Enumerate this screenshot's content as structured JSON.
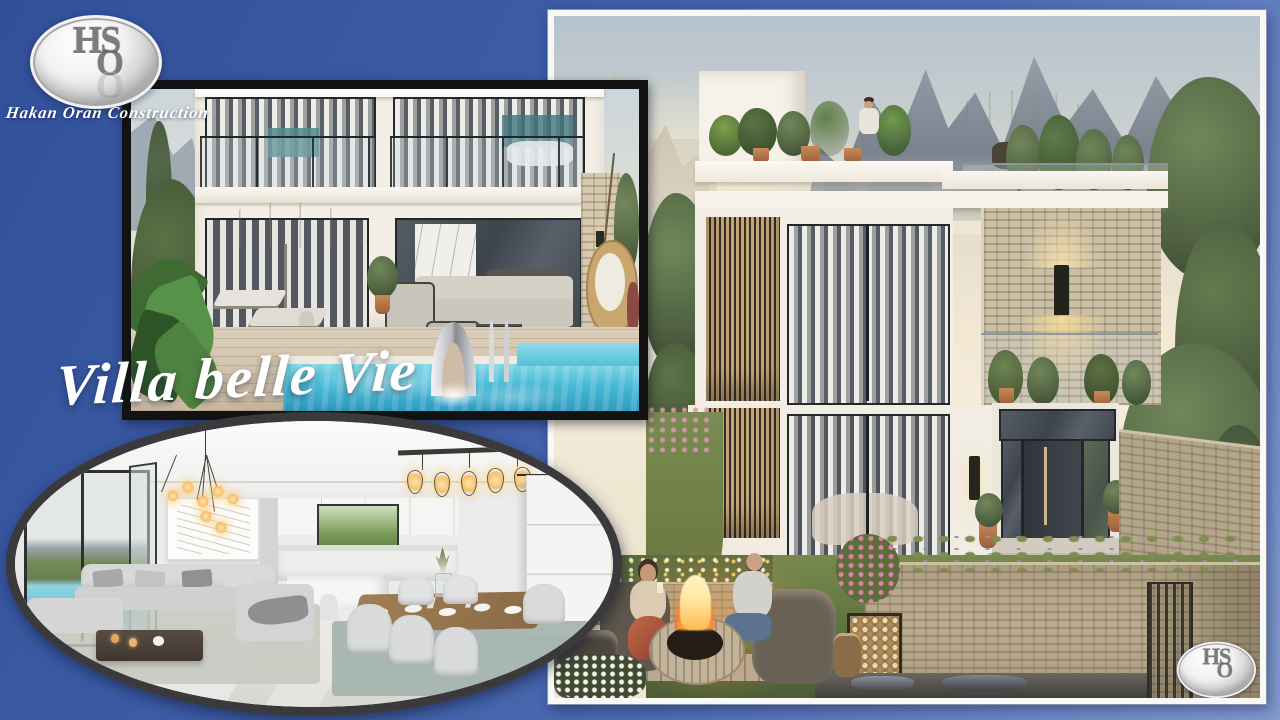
{
  "brand": {
    "monogram_top": "HS",
    "monogram_bottom": "O",
    "company": "Hakan Oran Construction"
  },
  "title": {
    "text": "Villa belle Vie"
  },
  "photos": {
    "exterior": {
      "alt": "3D render of a modern two-storey white villa with rooftop terrace, stone feature wall, mountain backdrop, garden and fire pit seating at dusk"
    },
    "pool": {
      "alt": "3D render of twin villa facades with glazed balconies, terrace parasol, lounge furniture and private pool with chrome waterfall feature"
    },
    "interior": {
      "alt": "Open-plan living and dining room in white and grey with pendant lighting and a view to the pool"
    }
  },
  "colors": {
    "background_top": "#32509A",
    "background_bottom": "#8199CF",
    "frame_black": "#131313",
    "frame_white": "#F8F8F6",
    "oval_rim": "#3A3A3C",
    "pool_water": "#49B9D4",
    "flame": "#FFA23E"
  }
}
